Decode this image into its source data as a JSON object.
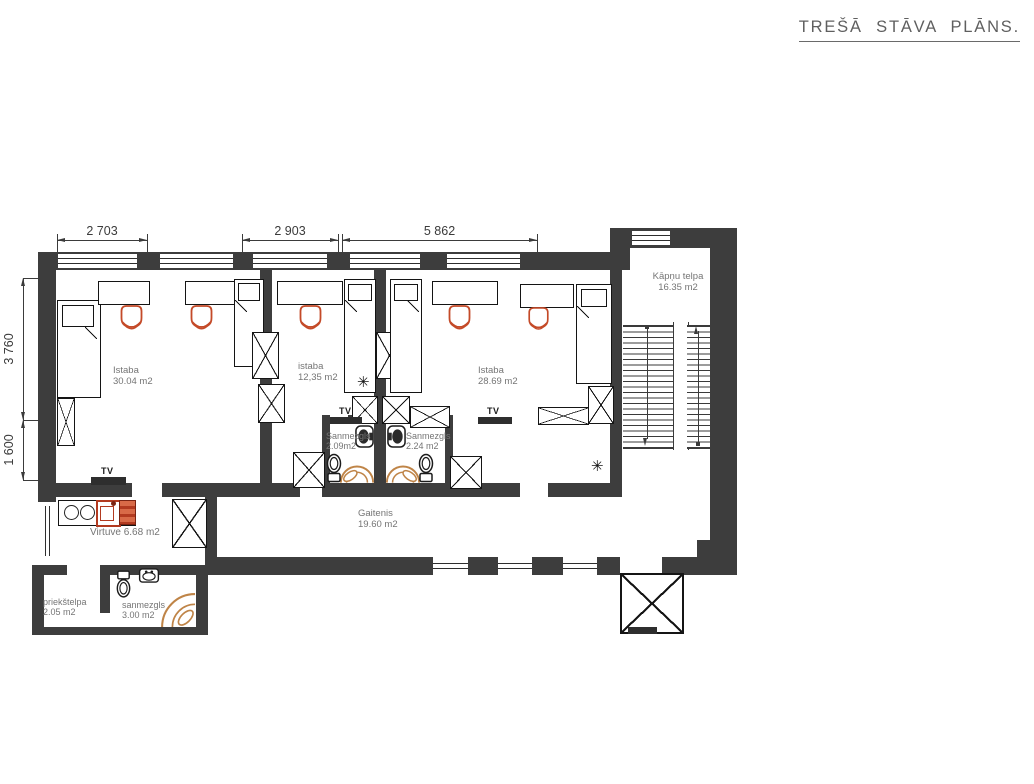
{
  "title": "TREŠĀ STĀVA PLĀNS.",
  "dimensions": {
    "top": [
      "2 703",
      "2 903",
      "5 862"
    ],
    "left": [
      "3 760",
      "1 600"
    ]
  },
  "rooms": {
    "istaba1": {
      "name": "Istaba",
      "area": "30.04 m2"
    },
    "istaba2": {
      "name": "istaba",
      "area": "12,35 m2"
    },
    "istaba3": {
      "name": "Istaba",
      "area": "28.69 m2"
    },
    "kapnu_telpa": {
      "name": "Kāpņu telpa",
      "area": "16.35 m2"
    },
    "sanmezgls1": {
      "name": "Sanmezgls",
      "area": "2.09m2"
    },
    "sanmezgls2": {
      "name": "Sanmezgls",
      "area": "2.24 m2"
    },
    "gaitenis": {
      "name": "Gaitenis",
      "area": "19.60 m2"
    },
    "virtuve": {
      "name": "Virtuve 6.68 m2"
    },
    "priekstelpa": {
      "name": "priekštelpa",
      "area": "2.05 m2"
    },
    "sanmezgls3": {
      "name": "sanmezgls",
      "area": "3.00 m2"
    }
  },
  "annotations": {
    "tv": "TV",
    "climate": "✳"
  },
  "colors": {
    "wall": "#3d3d3d",
    "chair": "#c44a28",
    "shower": "#bf8447",
    "kitchen_red": "#b23a20",
    "label": "#757575",
    "dim": "#3b3b3b",
    "title": "#5f5f5f"
  }
}
